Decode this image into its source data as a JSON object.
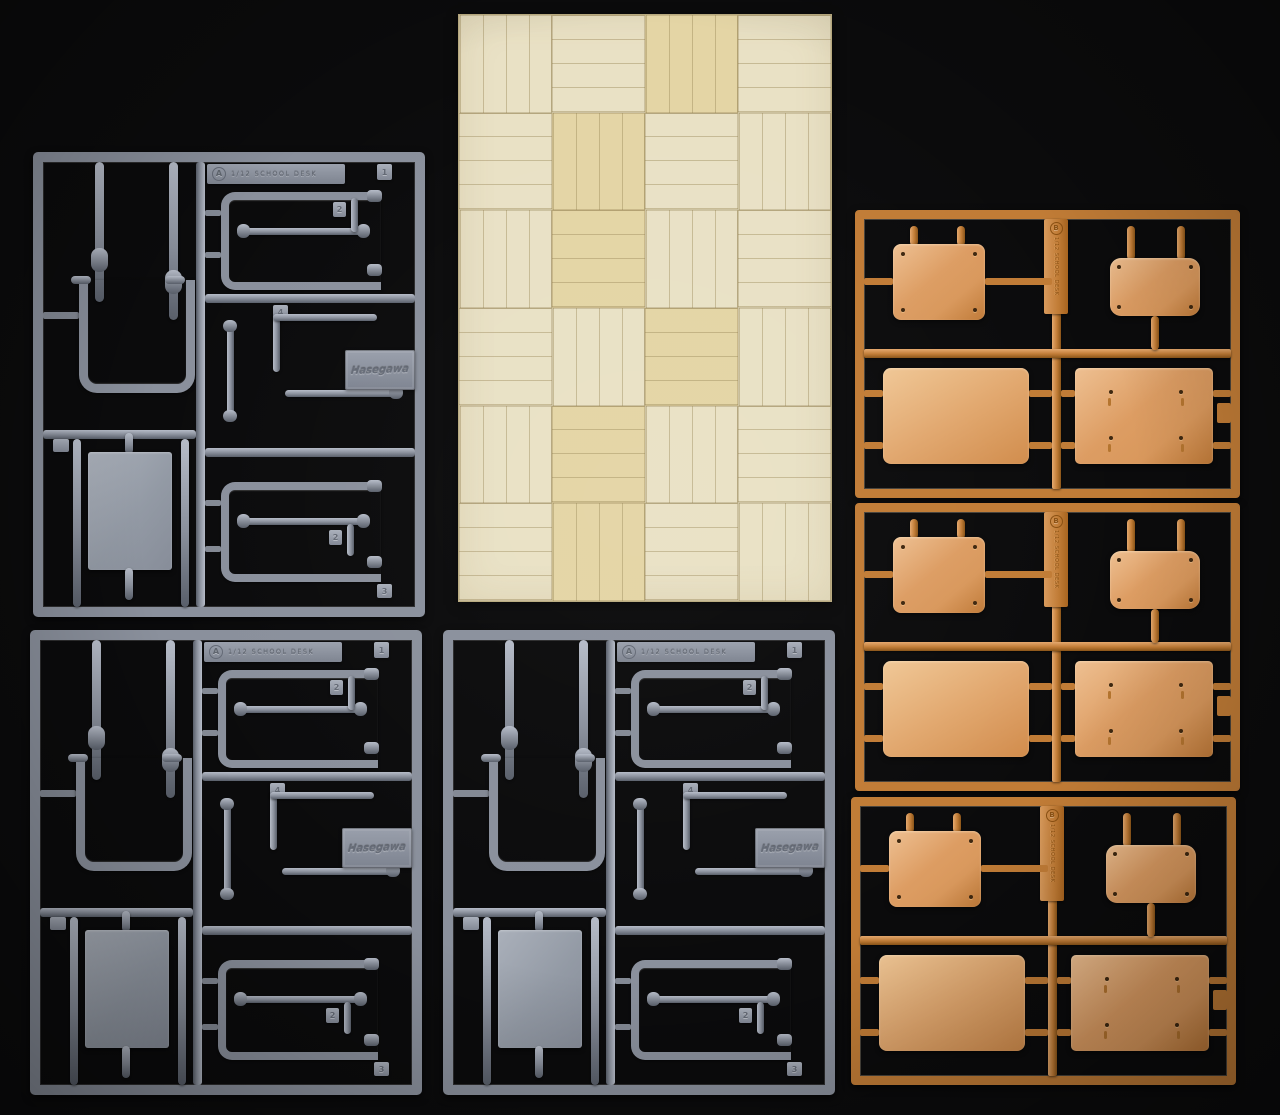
{
  "colors": {
    "background": "#0b0b0c",
    "gray": "#8a909c",
    "gray_light": "#b6bcc8",
    "gray_dark": "#595f6a",
    "gray_panel": "#9ba1ac",
    "orange": "#c17c36",
    "orange_light": "#e5a96e",
    "orange_dark": "#8a5418",
    "orange_panel": "#d9985c",
    "wood": "#e9e1c5",
    "wood_line": "#b9aa7c",
    "wood_warm": "#e4d5a5"
  },
  "gray_sprue": {
    "runner_letter": "A",
    "runner_label": "1/12 SCHOOL DESK",
    "brand": "Hasegawa",
    "tags": {
      "t1": "1",
      "t2": "2",
      "t3": "4",
      "t4": "2",
      "t5": "3"
    }
  },
  "orange_sprue": {
    "runner_letter": "B",
    "runner_label": "1/12 SCHOOL DESK"
  },
  "wood_sheet": {
    "cols": 4,
    "rows": 6,
    "warm_tiles": [
      2,
      5,
      9,
      14,
      17,
      21
    ]
  }
}
